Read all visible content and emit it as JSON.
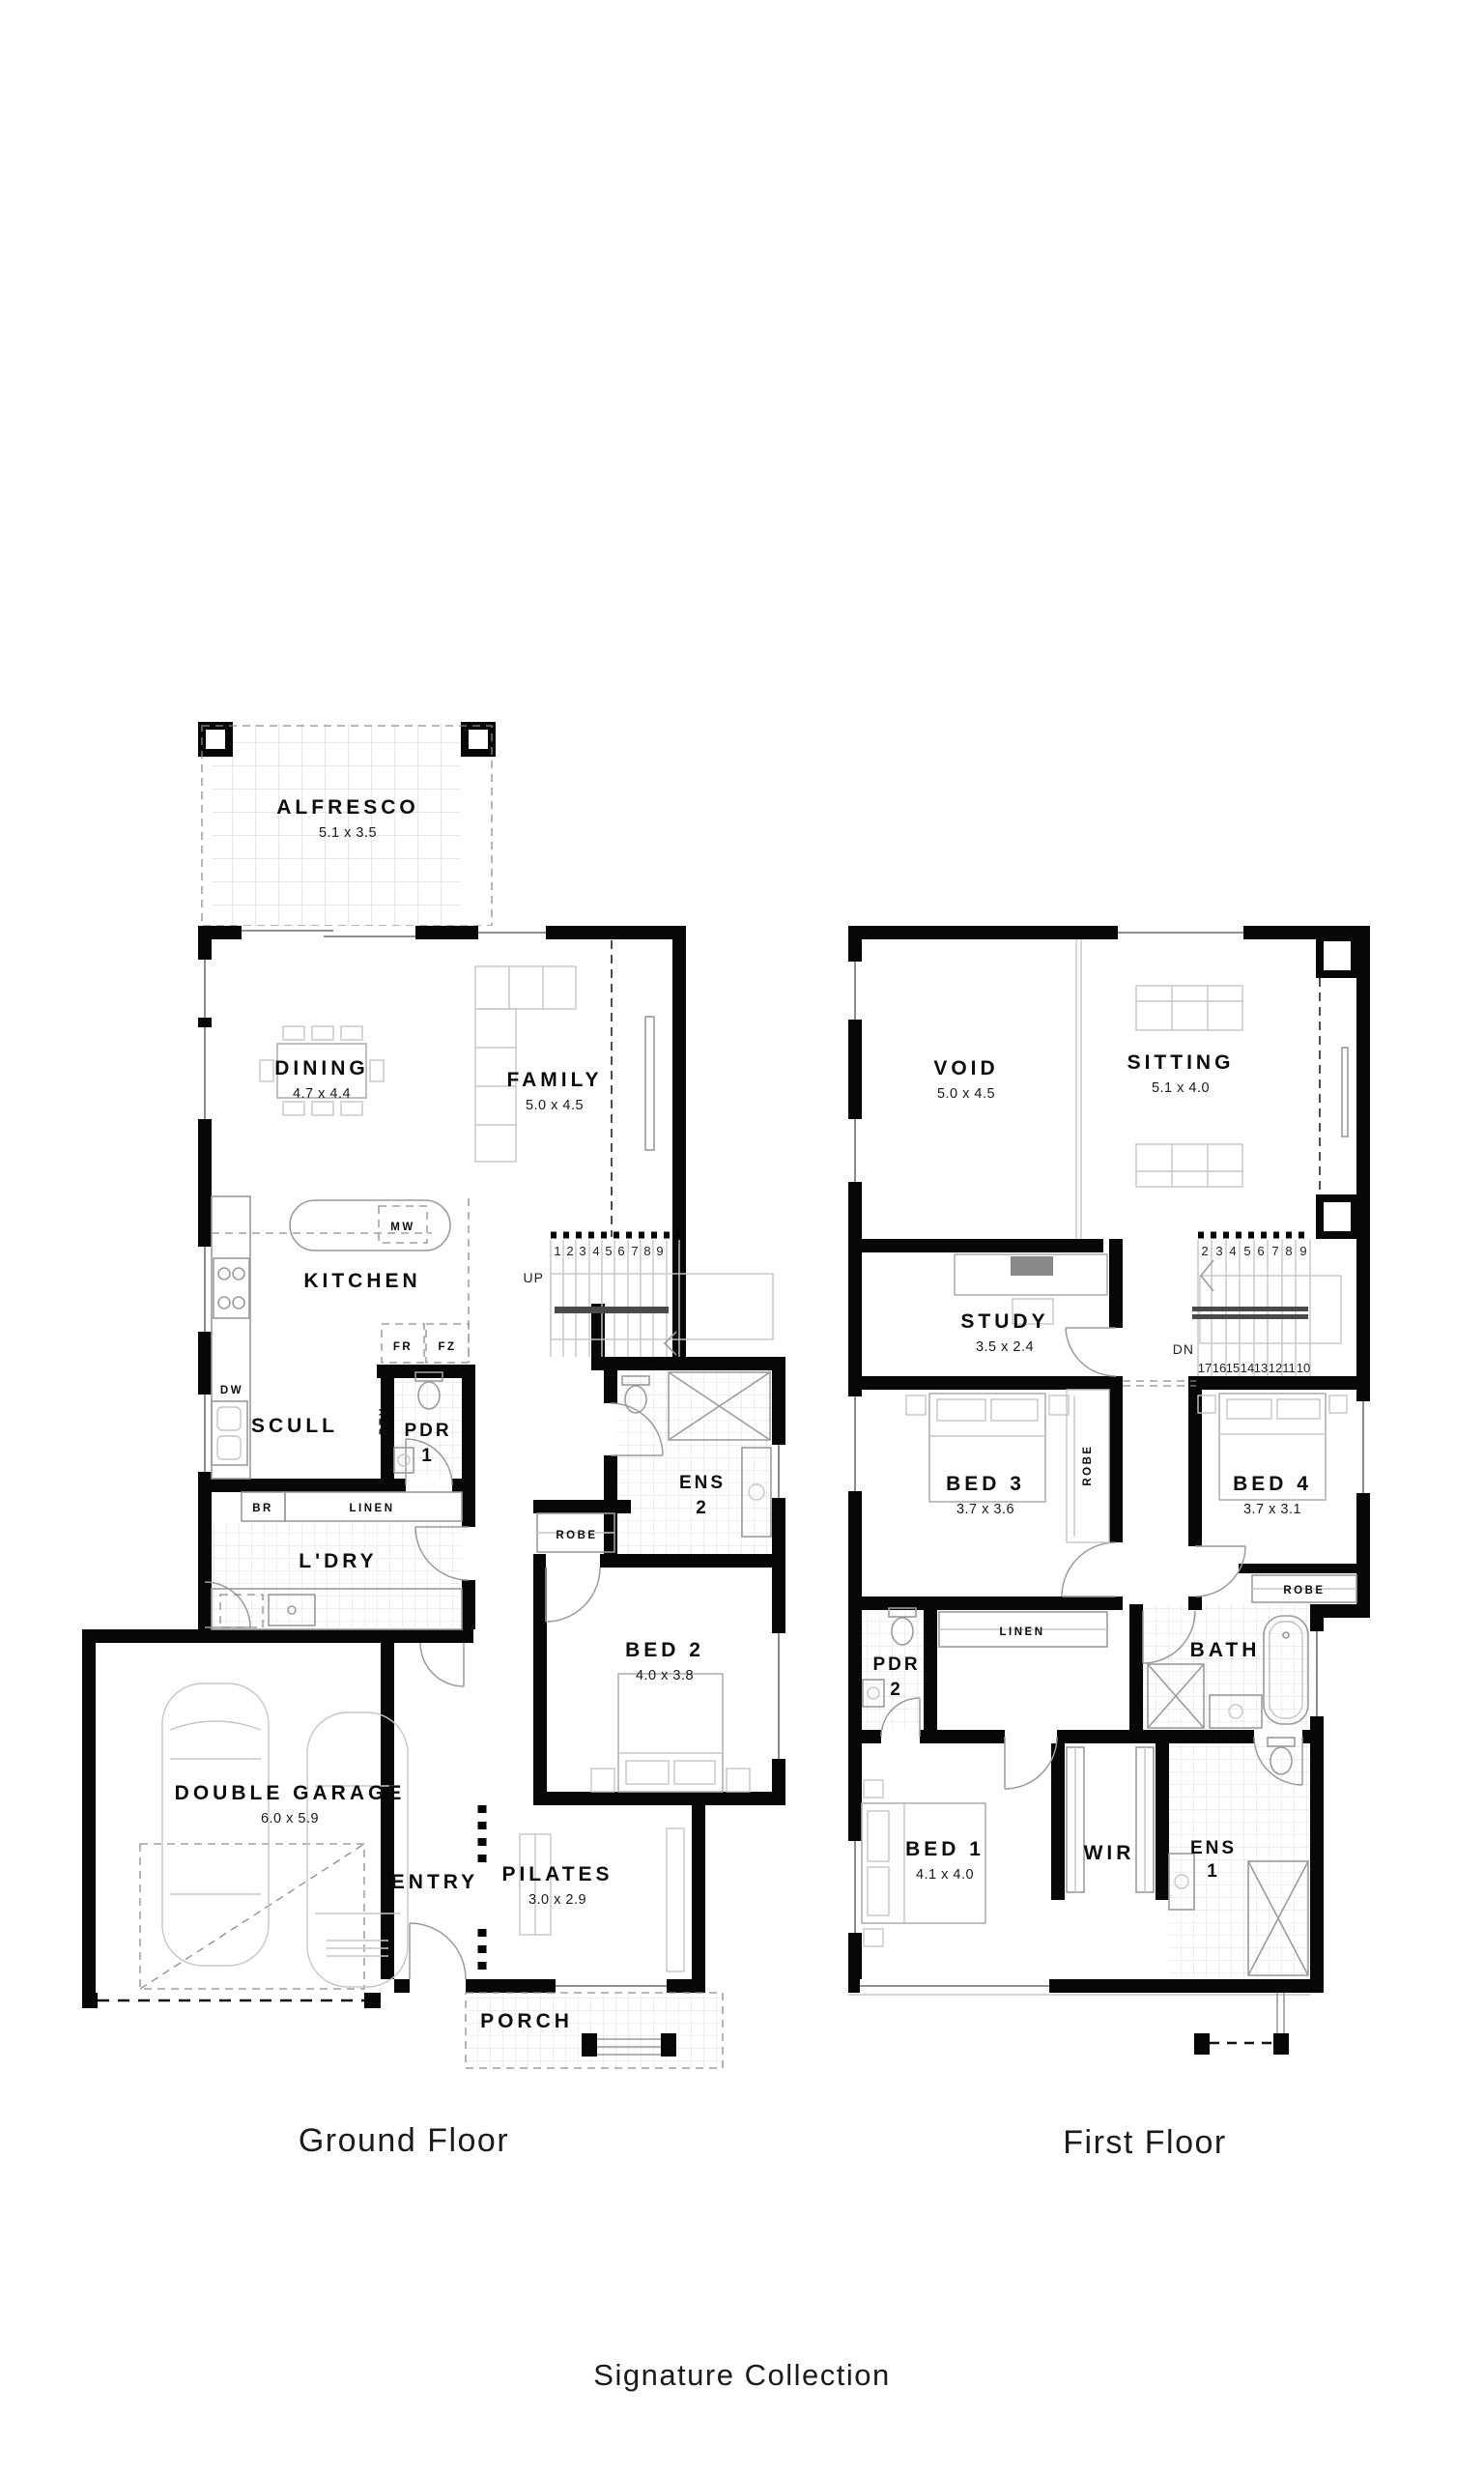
{
  "colors": {
    "ink": "#000000",
    "tile_line": "#dcdcdc"
  },
  "captions": {
    "ground": "Ground Floor",
    "first": "First Floor"
  },
  "footer": {
    "collection_label": "Signature Collection"
  },
  "ground_floor": {
    "alfresco": {
      "name": "ALFRESCO",
      "dims": "5.1 x 3.5"
    },
    "dining": {
      "name": "DINING",
      "dims": "4.7 x 4.4"
    },
    "family": {
      "name": "FAMILY",
      "dims": "5.0 x 4.5"
    },
    "kitchen": {
      "name": "KITCHEN"
    },
    "scullery": {
      "name": "SCULL"
    },
    "pantry": {
      "name": "PTY"
    },
    "pdr1": {
      "name": "PDR",
      "number": "1"
    },
    "ens2": {
      "name": "ENS",
      "number": "2"
    },
    "robe": {
      "name": "ROBE"
    },
    "bed2": {
      "name": "BED 2",
      "dims": "4.0 x 3.8"
    },
    "broom": {
      "name": "BR"
    },
    "linen": {
      "name": "LINEN"
    },
    "laundry": {
      "name": "L'DRY"
    },
    "garage": {
      "name": "DOUBLE GARAGE",
      "dims": "6.0 x 5.9"
    },
    "entry": {
      "name": "ENTRY"
    },
    "pilates": {
      "name": "PILATES",
      "dims": "3.0 x 2.9"
    },
    "porch": {
      "name": "PORCH"
    },
    "appliances": {
      "mw": "MW",
      "fr": "FR",
      "fz": "FZ",
      "dw": "DW"
    },
    "stairs": {
      "direction": "UP",
      "steps": [
        "1",
        "2",
        "3",
        "4",
        "5",
        "6",
        "7",
        "8",
        "9"
      ]
    }
  },
  "first_floor": {
    "void": {
      "name": "VOID",
      "dims": "5.0 x 4.5"
    },
    "sitting": {
      "name": "SITTING",
      "dims": "5.1 x 4.0"
    },
    "study": {
      "name": "STUDY",
      "dims": "3.5 x 2.4"
    },
    "bed3": {
      "name": "BED 3",
      "dims": "3.7 x 3.6"
    },
    "bed4": {
      "name": "BED 4",
      "dims": "3.7 x 3.1"
    },
    "robe_bed3": {
      "name": "ROBE"
    },
    "robe_bed4": {
      "name": "ROBE"
    },
    "linen": {
      "name": "LINEN"
    },
    "pdr2": {
      "name": "PDR",
      "number": "2"
    },
    "bath": {
      "name": "BATH"
    },
    "bed1": {
      "name": "BED 1",
      "dims": "4.1 x 4.0"
    },
    "wir": {
      "name": "WIR"
    },
    "ens1": {
      "name": "ENS",
      "number": "1"
    },
    "stairs": {
      "direction": "DN",
      "steps_upper": [
        "2",
        "3",
        "4",
        "5",
        "6",
        "7",
        "8",
        "9"
      ],
      "steps_lower": [
        "17",
        "16",
        "15",
        "14",
        "13",
        "12",
        "11",
        "10"
      ]
    }
  }
}
